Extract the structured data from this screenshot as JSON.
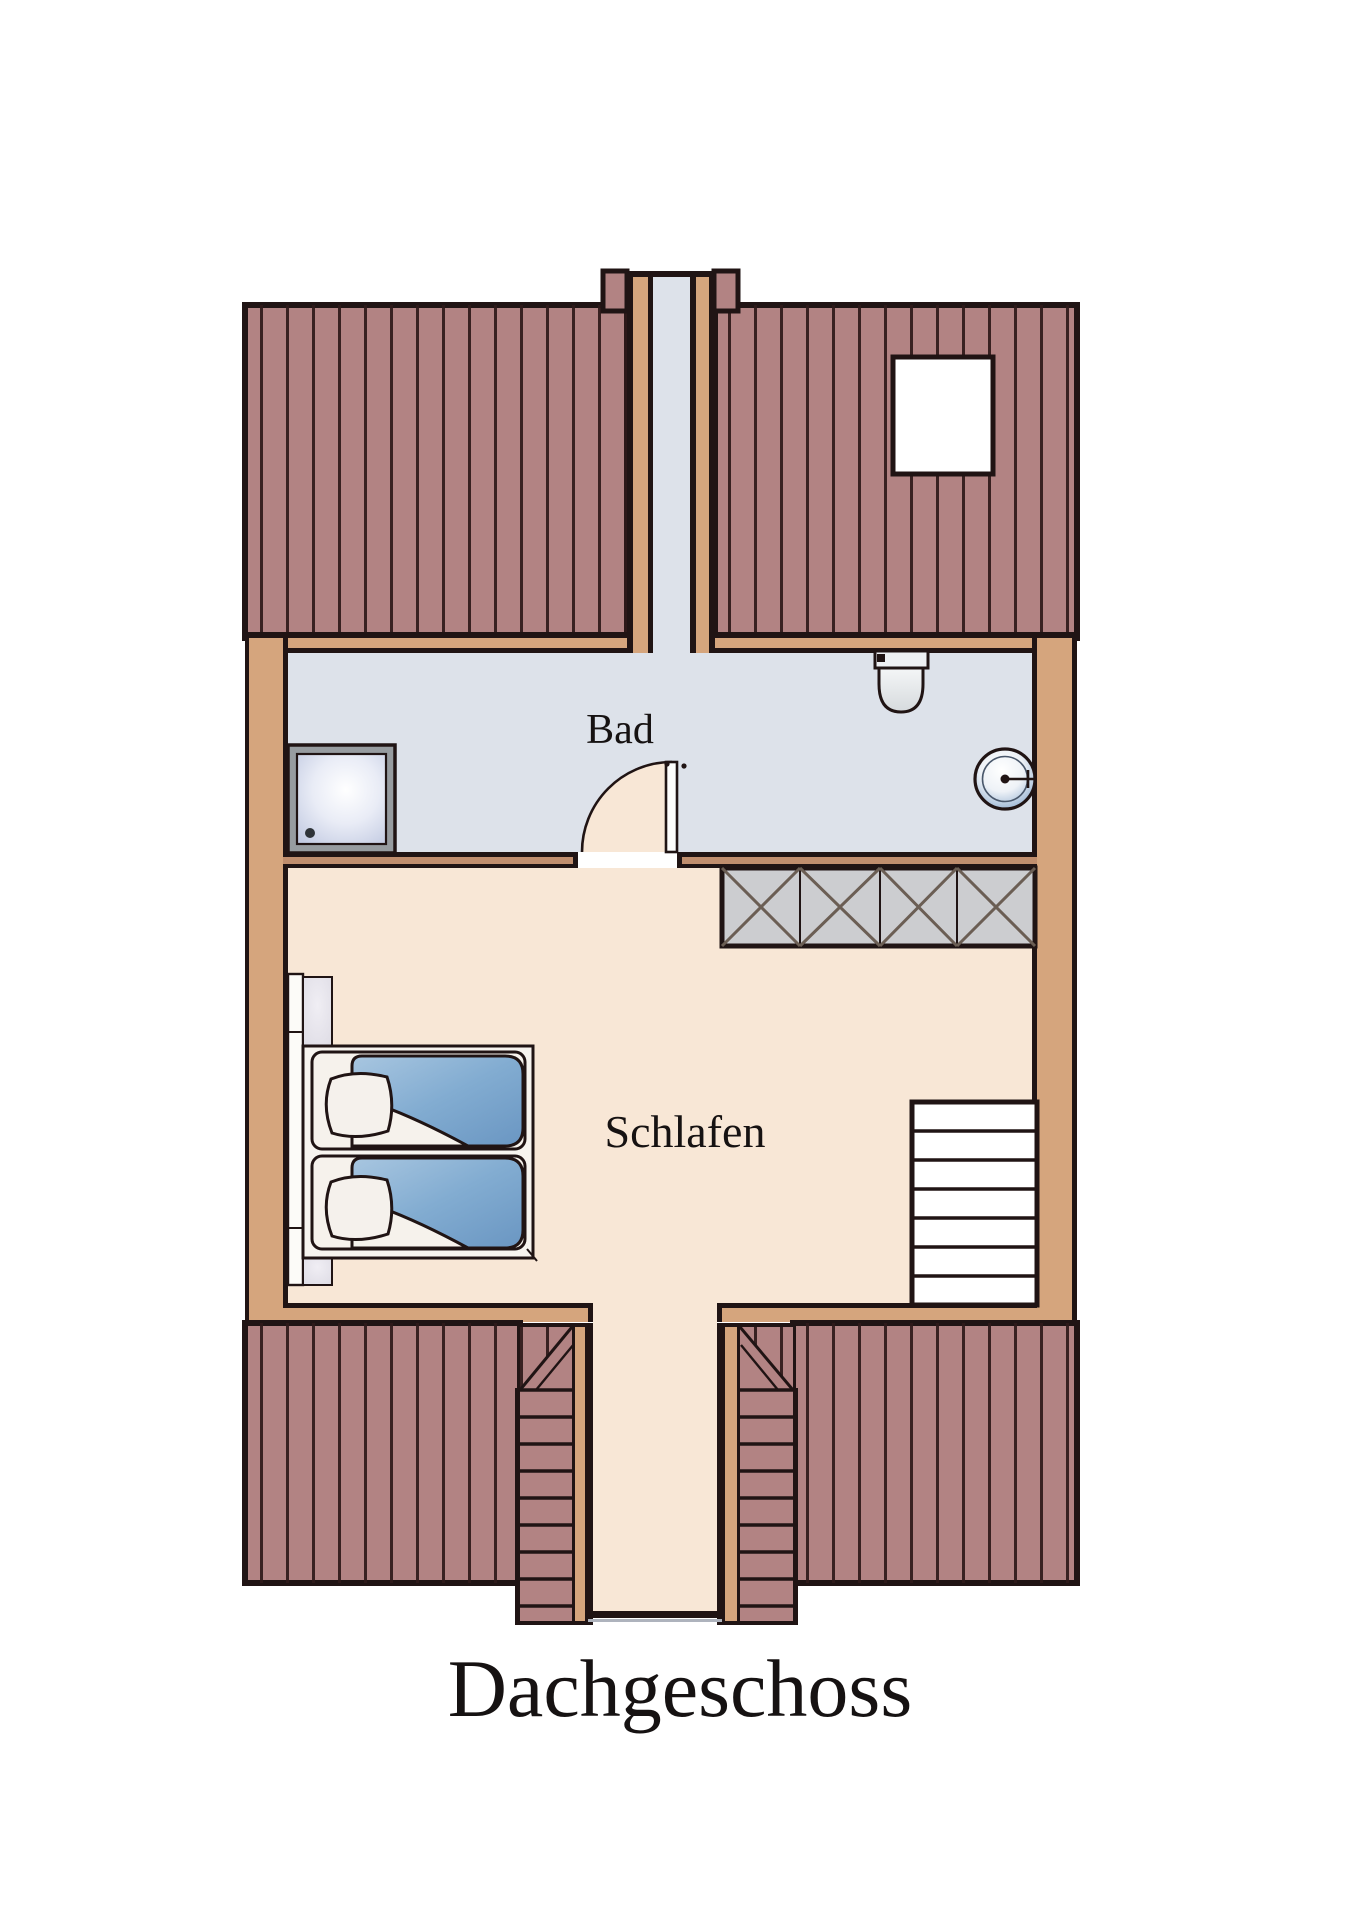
{
  "labels": {
    "title": "Dachgeschoss",
    "bad": "Bad",
    "schlafen": "Schlafen"
  },
  "plan": {
    "floor_name": "Dachgeschoss",
    "rooms": [
      {
        "name": "Bad"
      },
      {
        "name": "Schlafen"
      }
    ],
    "fixture_names": [
      "shower",
      "toilet",
      "washbasin",
      "wardrobe",
      "double-bed",
      "upper-stairs",
      "lower-stair-flights",
      "skylight-window",
      "stairwell-shaft",
      "interior-door"
    ]
  },
  "palette": {
    "line": "#201414",
    "roof": "#b28383",
    "roof_stripe": "#2e1919",
    "wall_tan": "#d5a57d",
    "wall_tan_dark": "#c08e6e",
    "bath_floor": "#dde2ea",
    "bed_floor": "#f8e7d6",
    "wardrobe_gray": "#cccdd0",
    "duvet_blue": "#82acd1",
    "fixture_white": "#f7f4ef",
    "text_color": "#161212"
  }
}
